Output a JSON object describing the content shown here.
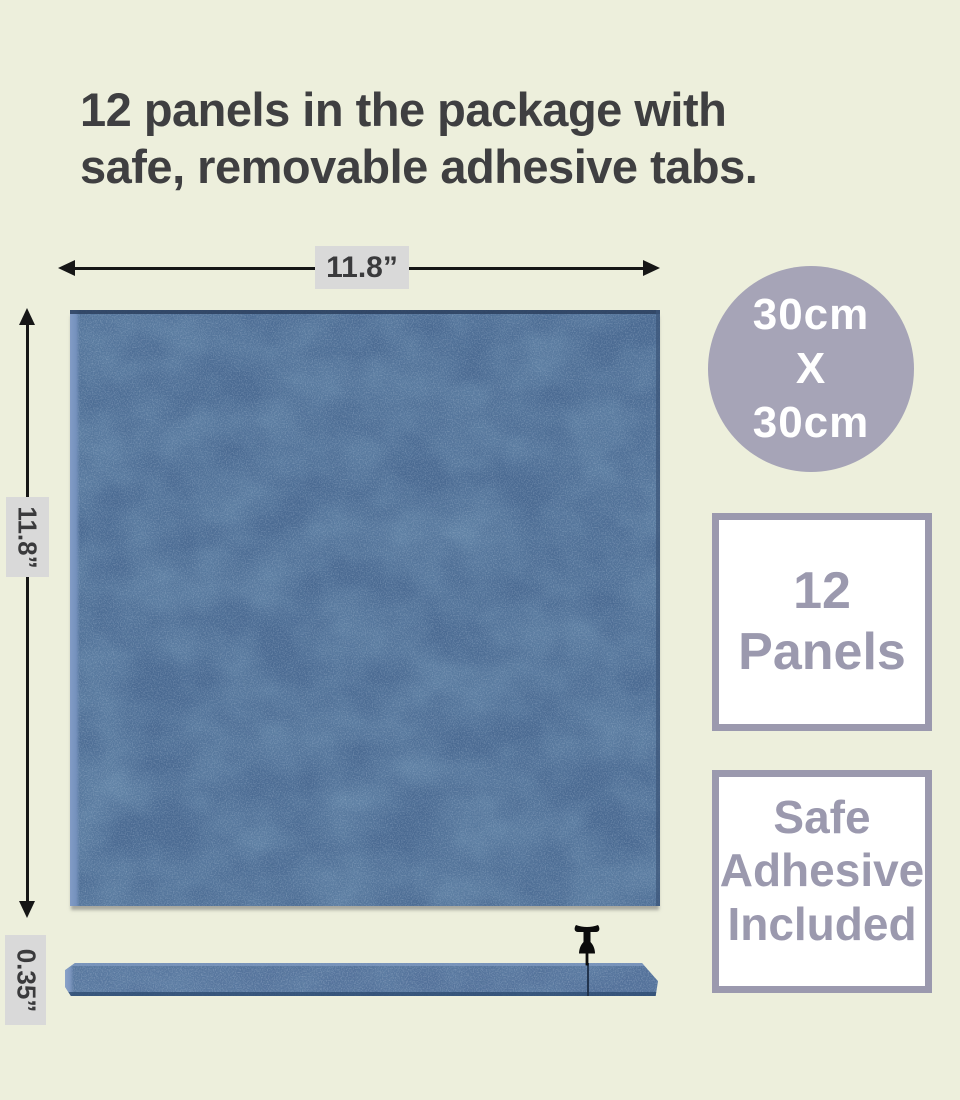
{
  "page": {
    "background_color": "#edefdc",
    "title_line1": "12 panels in the package with",
    "title_line2": "safe, removable adhesive tabs."
  },
  "dimensions": {
    "width_label": "11.8”",
    "height_label": "11.8”",
    "thickness_label": "0.35”"
  },
  "badges": {
    "size_circle": {
      "line1": "30cm",
      "line2": "X",
      "line3": "30cm",
      "bg_color": "#a6a4b7",
      "text_color": "#ffffff"
    },
    "panels_box": {
      "line1": "12",
      "line2": "Panels",
      "border_color": "#9b99ae",
      "text_color": "#9b99ae"
    },
    "adhesive_box": {
      "line1": "Safe",
      "line2": "Adhesive",
      "line3": "Included",
      "border_color": "#9b99ae",
      "text_color": "#9b99ae"
    }
  },
  "product": {
    "panel_base_color": "#4a6a92",
    "panel_light_fiber_color": "#7e9aba",
    "panel_dark_patch_color": "#32527a",
    "icons": {
      "push_pin": "push-pin-icon"
    }
  }
}
